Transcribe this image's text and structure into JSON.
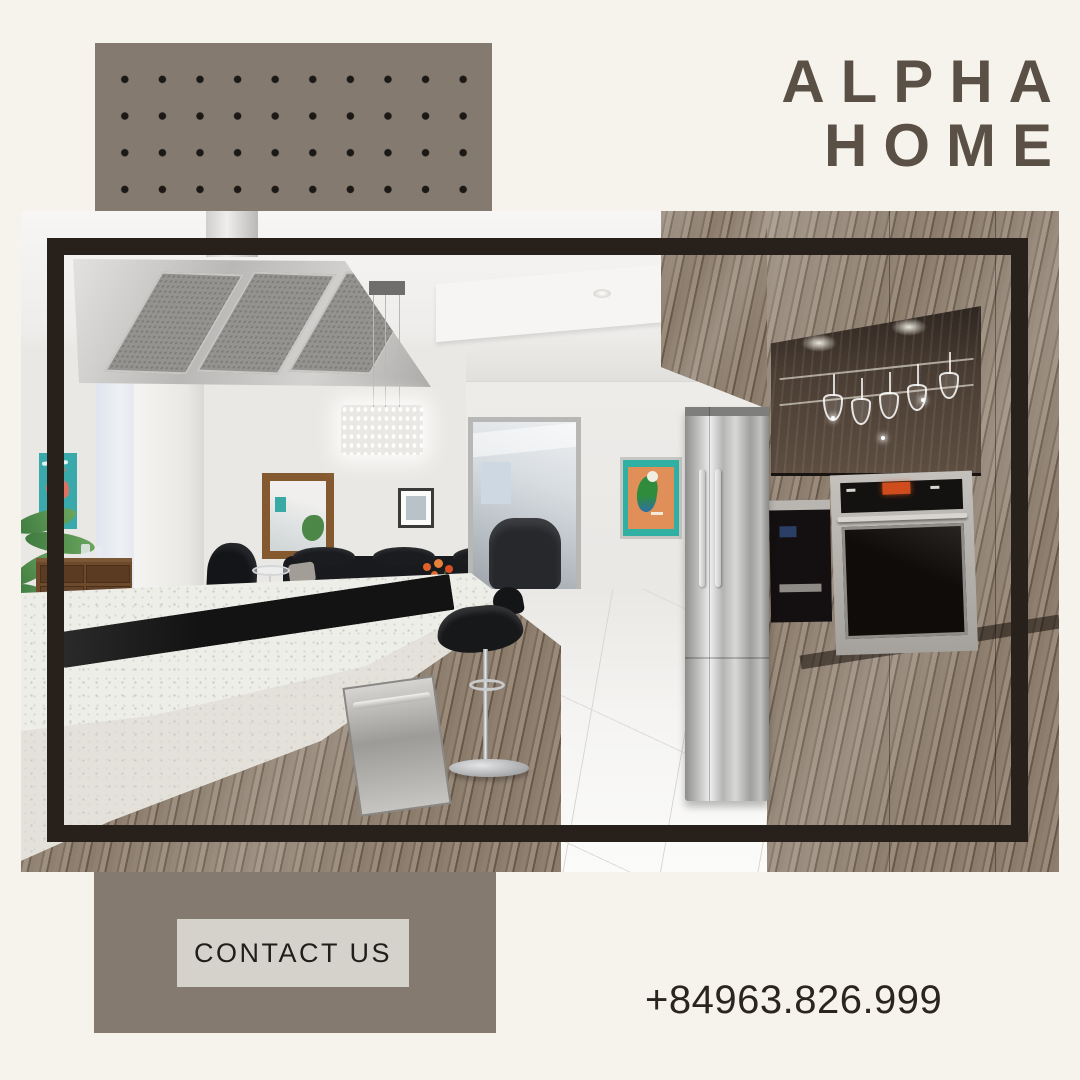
{
  "brand": {
    "line1": "ALPHA",
    "line2": "HOME"
  },
  "cta": {
    "label": "CONTACT US"
  },
  "contact": {
    "phone": "+84963.826.999"
  },
  "colors": {
    "background": "#f6f3ec",
    "taupe_block": "#847a6f",
    "dot": "#1b1815",
    "title_text": "#5a5046",
    "photo_frame": "#28211b",
    "button_bg": "#d5d2cb",
    "button_text": "#201e1b",
    "phone_text": "#2b2520"
  },
  "photo": {
    "subject": "modern kitchen interior with island cooktop, stainless range hood, refrigerator, wall oven, wood cabinetry and wine glass rack"
  }
}
